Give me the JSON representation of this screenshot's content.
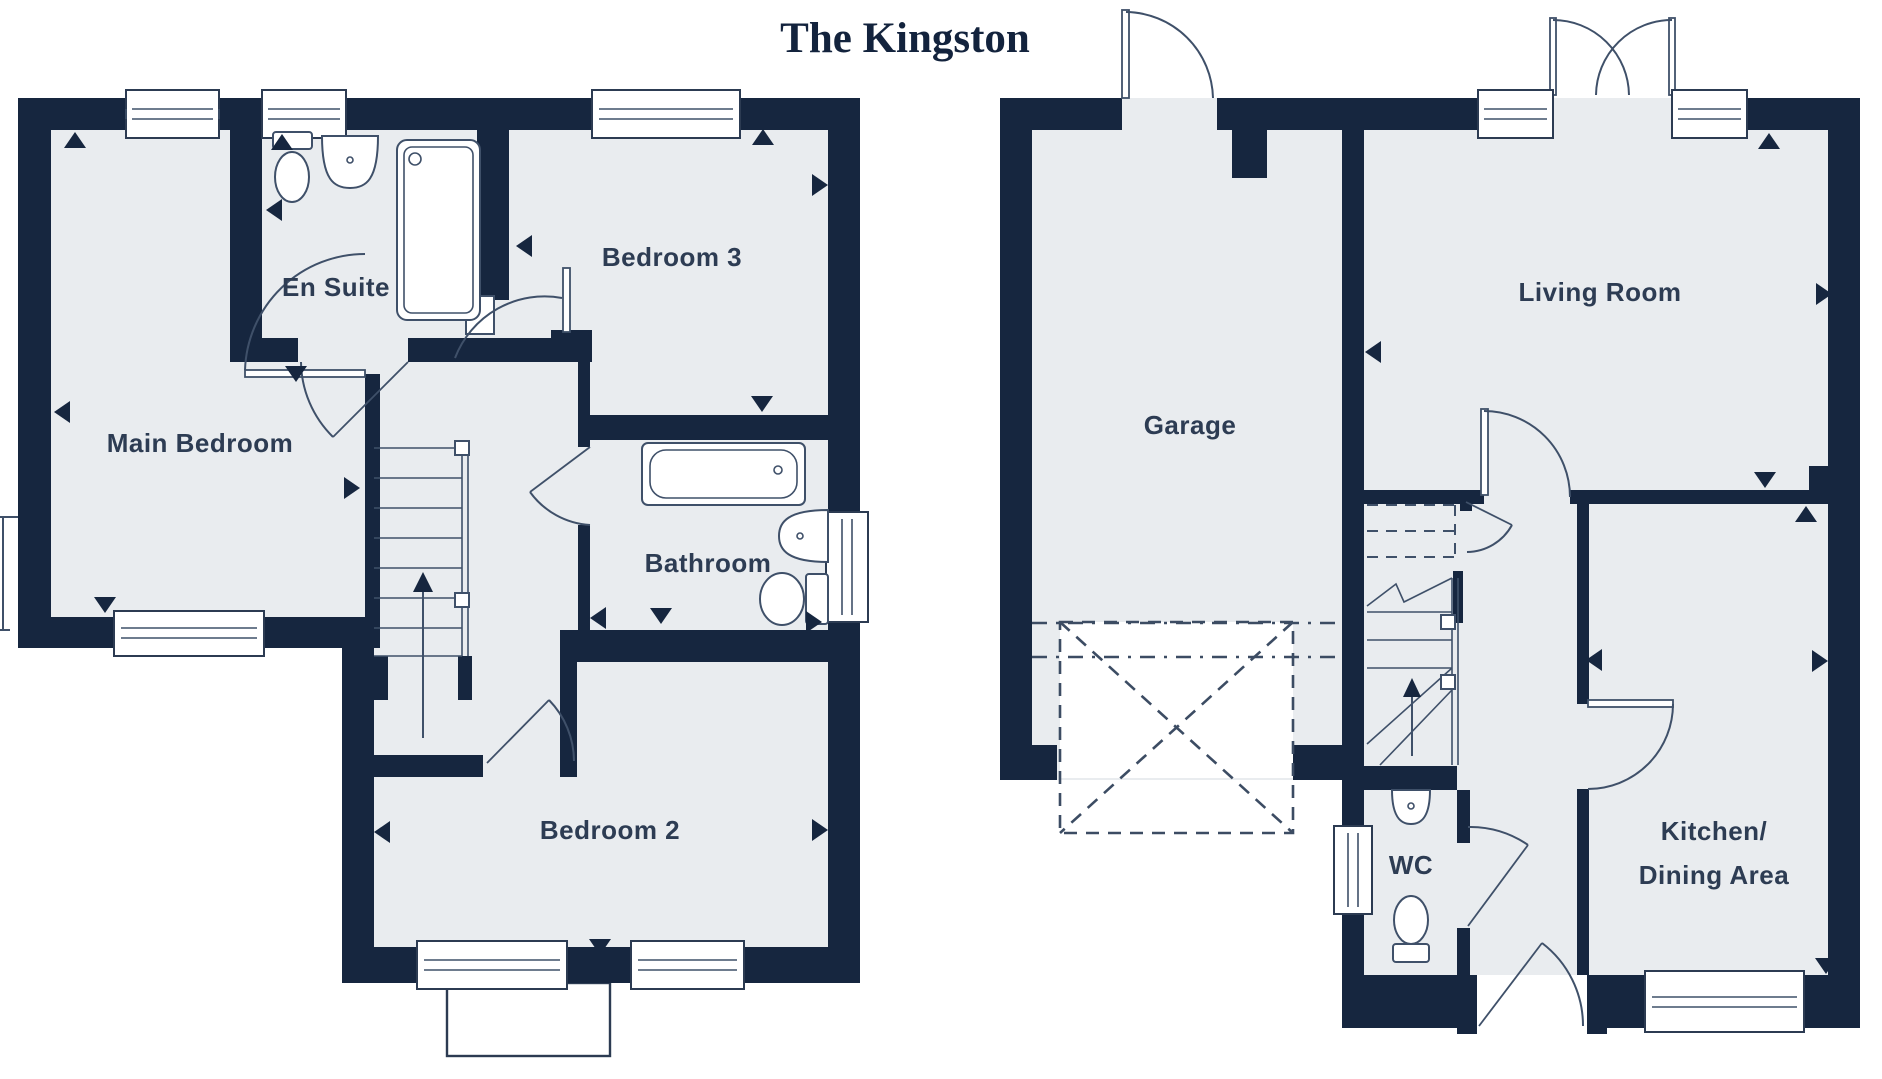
{
  "title": "The Kingston",
  "colors": {
    "wall": "#16263f",
    "floor": "#e9ecef",
    "detail_line": "#3f5069",
    "label_text": "#2d3c53",
    "title_text": "#13233d",
    "background": "#ffffff"
  },
  "plans": {
    "first_floor": {
      "rooms": [
        "Main Bedroom",
        "En Suite",
        "Bedroom 3",
        "Bathroom",
        "Bedroom 2"
      ]
    },
    "ground_floor": {
      "rooms": [
        "Garage",
        "Living Room",
        "WC",
        "Kitchen/ Dining Area"
      ]
    }
  },
  "labels": {
    "main_bedroom": "Main Bedroom",
    "en_suite": "En Suite",
    "bedroom_3": "Bedroom 3",
    "bathroom": "Bathroom",
    "bedroom_2": "Bedroom 2",
    "garage": "Garage",
    "living_room": "Living Room",
    "wc": "WC",
    "kitchen_line1": "Kitchen/",
    "kitchen_line2": "Dining Area"
  }
}
